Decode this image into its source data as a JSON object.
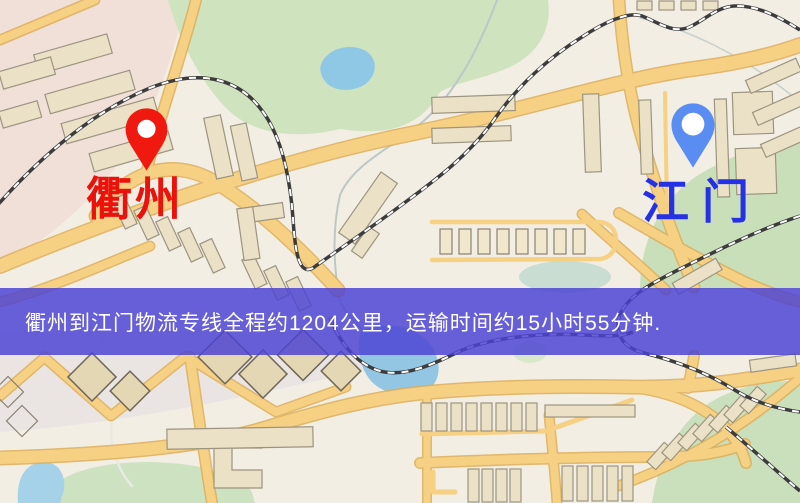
{
  "map": {
    "origin": {
      "label": "衢州",
      "label_color": "#ea120b",
      "pin_color": "#f0190f"
    },
    "destination": {
      "label": "江门",
      "label_color": "#2531e4",
      "pin_color": "#5a8df2"
    },
    "banner": {
      "text": "衢州到江门物流专线全程约1204公里，运输时间约15小时55分钟.",
      "background": "#4a42d4",
      "text_color": "#ffffff"
    },
    "route": {
      "distance_km": "1204",
      "duration": "15小时55分钟"
    }
  },
  "palette": {
    "map_background": "#f3eee3",
    "road_fill": "#f6d083",
    "road_casing": "#ddae58",
    "building_fill": "#eae1c6",
    "building_outline": "#9d9480",
    "park_green": "#cfe3bf",
    "water_blue": "#92c7e3",
    "railway_dark": "#3c3c3c",
    "pink_tint": "#eecdc8"
  }
}
